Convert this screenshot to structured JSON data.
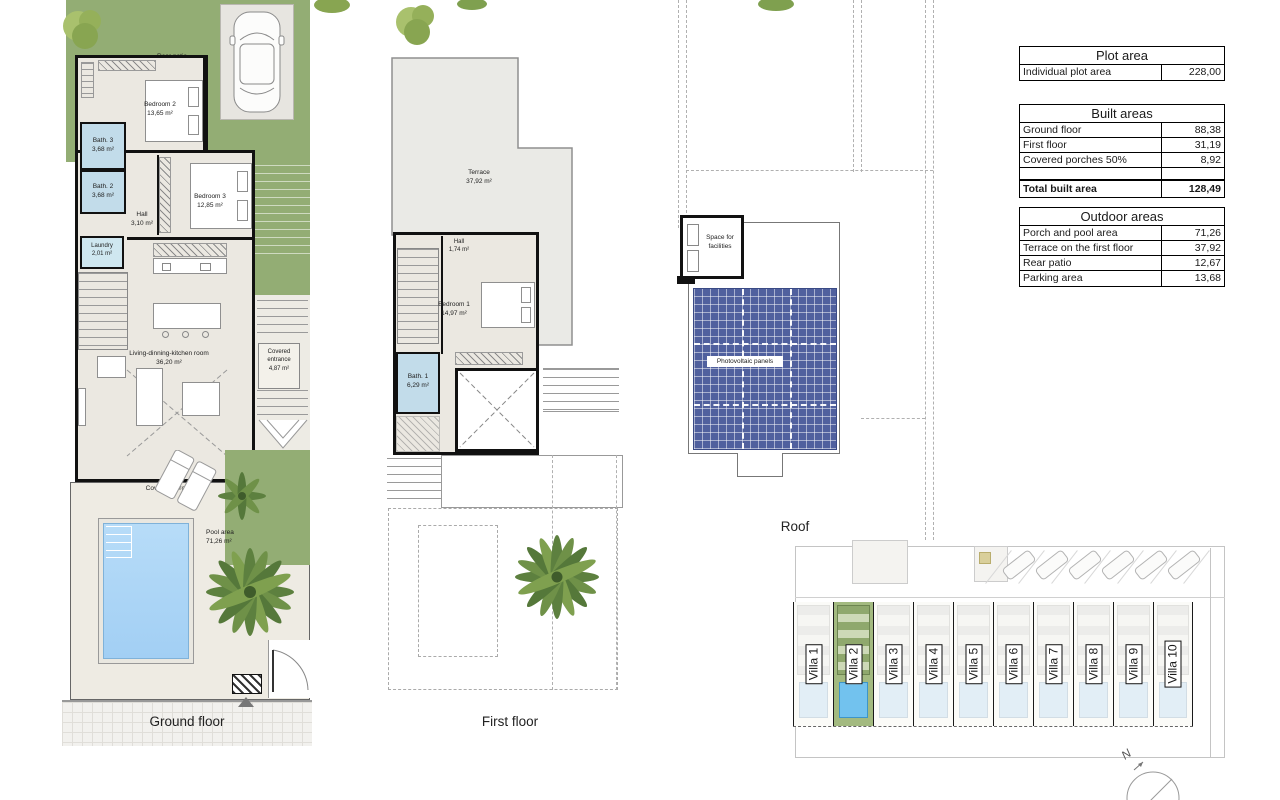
{
  "tables": {
    "plot": {
      "title": "Plot area",
      "rows": [
        {
          "label": "Individual plot area",
          "value": "228,00"
        }
      ]
    },
    "built": {
      "title": "Built areas",
      "rows": [
        {
          "label": "Ground floor",
          "value": "88,38"
        },
        {
          "label": "First floor",
          "value": "31,19"
        },
        {
          "label": "Covered porches 50%",
          "value": "8,92"
        },
        {
          "label": "",
          "value": ""
        },
        {
          "label": "Total built area",
          "value": "128,49"
        }
      ]
    },
    "outdoor": {
      "title": "Outdoor areas",
      "rows": [
        {
          "label": "Porch and pool area",
          "value": "71,26"
        },
        {
          "label": "Terrace on the first floor",
          "value": "37,92"
        },
        {
          "label": "Rear patio",
          "value": "12,67"
        },
        {
          "label": "Parking area",
          "value": "13,68"
        }
      ]
    }
  },
  "ground_floor": {
    "label": "Ground floor",
    "rear_patio": {
      "name": "Rear patio",
      "area": "13,00 m²"
    },
    "bedroom2": {
      "name": "Bedroom 2",
      "area": "13,65 m²"
    },
    "bath3": {
      "name": "Bath. 3",
      "area": "3,68 m²"
    },
    "bath2": {
      "name": "Bath. 2",
      "area": "3,68 m²"
    },
    "hall": {
      "name": "Hall",
      "area": "3,10 m²"
    },
    "bedroom3": {
      "name": "Bedroom 3",
      "area": "12,85 m²"
    },
    "laundry": {
      "name": "Laundry",
      "area": "2,01 m²"
    },
    "living": {
      "name": "Living-dinning-kitchen room",
      "area": "36,20 m²"
    },
    "covered_entrance": {
      "name": "Covered entrance",
      "area": "4,87 m²"
    },
    "covered_porch": {
      "name": "Covered porch"
    },
    "pool": {
      "name": "Pool area",
      "area": "71,26 m²"
    }
  },
  "first_floor": {
    "label": "First floor",
    "terrace": {
      "name": "Terrace",
      "area": "37,92 m²"
    },
    "hall": {
      "name": "Hall",
      "area": "1,74 m²"
    },
    "bedroom1": {
      "name": "Bedroom 1",
      "area": "14,97 m²"
    },
    "bath1": {
      "name": "Bath. 1",
      "area": "6,29 m²"
    }
  },
  "roof": {
    "label": "Roof",
    "facilities": {
      "name": "Space for facilities"
    },
    "panels": {
      "name": "Photovoltaic panels"
    }
  },
  "site": {
    "villas": [
      "Villa 1",
      "Villa 2",
      "Villa 3",
      "Villa 4",
      "Villa 5",
      "Villa 6",
      "Villa 7",
      "Villa 8",
      "Villa 9",
      "Villa 10"
    ],
    "compass": "N"
  },
  "colors": {
    "garden_green": "#93ad74",
    "floor_beige": "#ebe8e1",
    "bath_blue": "#c2dcea",
    "pool_blue": "#a9d3f5",
    "panel_blue": "#50609e",
    "wall_black": "#111111"
  }
}
